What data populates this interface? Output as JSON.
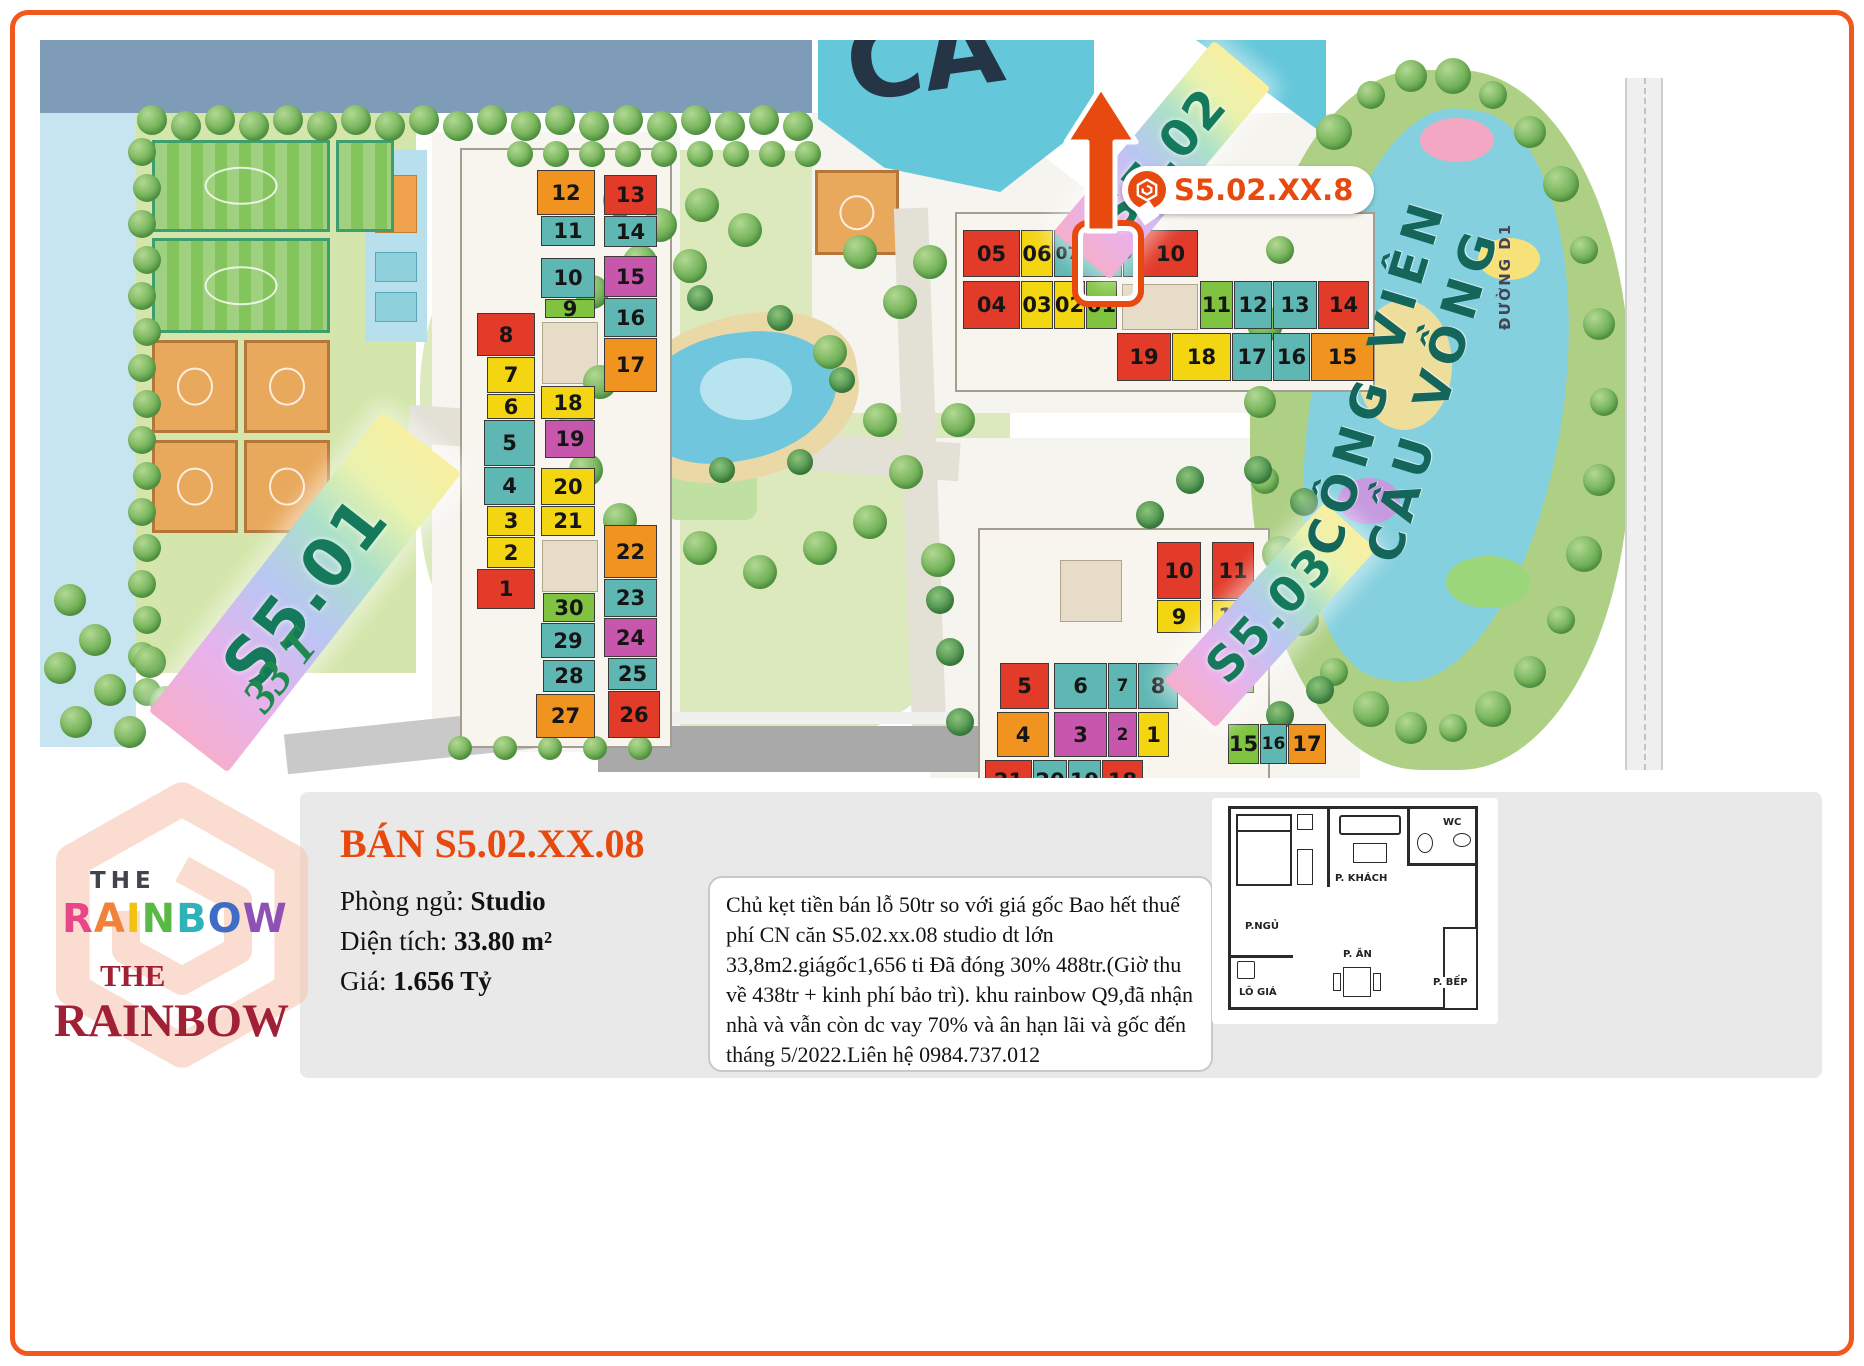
{
  "colors": {
    "accent": "#f2571c",
    "title": "#e8490f",
    "park_text": "#15665a",
    "logo_red": "#a02136",
    "unit": {
      "red": "#e23b2a",
      "yellow": "#f4d512",
      "teal": "#5fb7b4",
      "green": "#7fc341",
      "orange": "#f0931f",
      "magenta": "#c757ad"
    }
  },
  "map": {
    "banner_s501": "S5.01",
    "banner_s502": "S5.02",
    "banner_s503": "S5.03",
    "floors_label": "33 T",
    "park_name_line1": "CÔNG VIÊN",
    "park_name_line2": "CẦU VỒNG",
    "road_label": "ĐƯỜNG D1",
    "pool_letters": "CẦ",
    "callout_label": "S5.02.XX.8",
    "highlighted_unit": "08",
    "buildings": {
      "s501": {
        "units": [
          {
            "n": "12",
            "c": "orange",
            "x": 537,
            "y": 170,
            "w": 58,
            "h": 45
          },
          {
            "n": "13",
            "c": "red",
            "x": 604,
            "y": 175,
            "w": 53,
            "h": 40
          },
          {
            "n": "11",
            "c": "teal",
            "x": 541,
            "y": 216,
            "w": 54,
            "h": 30
          },
          {
            "n": "14",
            "c": "teal",
            "x": 604,
            "y": 216,
            "w": 53,
            "h": 31
          },
          {
            "n": "10",
            "c": "teal",
            "x": 541,
            "y": 258,
            "w": 54,
            "h": 40
          },
          {
            "n": "15",
            "c": "magenta",
            "x": 604,
            "y": 256,
            "w": 53,
            "h": 41
          },
          {
            "n": "9",
            "c": "green",
            "x": 545,
            "y": 299,
            "w": 50,
            "h": 19
          },
          {
            "n": "16",
            "c": "teal",
            "x": 604,
            "y": 298,
            "w": 53,
            "h": 39
          },
          {
            "n": "17",
            "c": "orange",
            "x": 604,
            "y": 338,
            "w": 53,
            "h": 54
          },
          {
            "n": "8",
            "c": "red",
            "x": 477,
            "y": 313,
            "w": 58,
            "h": 43
          },
          {
            "n": "7",
            "c": "yellow",
            "x": 487,
            "y": 357,
            "w": 48,
            "h": 36
          },
          {
            "n": "6",
            "c": "yellow",
            "x": 487,
            "y": 394,
            "w": 48,
            "h": 25
          },
          {
            "n": "18",
            "c": "yellow",
            "x": 541,
            "y": 386,
            "w": 54,
            "h": 33
          },
          {
            "n": "5",
            "c": "teal",
            "x": 484,
            "y": 420,
            "w": 51,
            "h": 46
          },
          {
            "n": "19",
            "c": "magenta",
            "x": 545,
            "y": 420,
            "w": 50,
            "h": 38
          },
          {
            "n": "4",
            "c": "teal",
            "x": 484,
            "y": 467,
            "w": 51,
            "h": 38
          },
          {
            "n": "20",
            "c": "yellow",
            "x": 541,
            "y": 468,
            "w": 54,
            "h": 37
          },
          {
            "n": "3",
            "c": "yellow",
            "x": 487,
            "y": 506,
            "w": 48,
            "h": 30
          },
          {
            "n": "21",
            "c": "yellow",
            "x": 541,
            "y": 506,
            "w": 54,
            "h": 30
          },
          {
            "n": "2",
            "c": "yellow",
            "x": 487,
            "y": 537,
            "w": 48,
            "h": 31
          },
          {
            "n": "22",
            "c": "orange",
            "x": 604,
            "y": 525,
            "w": 53,
            "h": 53
          },
          {
            "n": "1",
            "c": "red",
            "x": 477,
            "y": 569,
            "w": 58,
            "h": 40
          },
          {
            "n": "30",
            "c": "green",
            "x": 543,
            "y": 593,
            "w": 52,
            "h": 29
          },
          {
            "n": "23",
            "c": "teal",
            "x": 604,
            "y": 579,
            "w": 53,
            "h": 38
          },
          {
            "n": "29",
            "c": "teal",
            "x": 541,
            "y": 623,
            "w": 54,
            "h": 35
          },
          {
            "n": "24",
            "c": "magenta",
            "x": 604,
            "y": 618,
            "w": 53,
            "h": 39
          },
          {
            "n": "28",
            "c": "teal",
            "x": 543,
            "y": 660,
            "w": 52,
            "h": 32
          },
          {
            "n": "25",
            "c": "teal",
            "x": 608,
            "y": 658,
            "w": 49,
            "h": 32
          },
          {
            "n": "27",
            "c": "orange",
            "x": 536,
            "y": 694,
            "w": 59,
            "h": 44
          },
          {
            "n": "26",
            "c": "red",
            "x": 608,
            "y": 691,
            "w": 52,
            "h": 47
          }
        ]
      },
      "s502": {
        "units": [
          {
            "n": "05",
            "c": "red",
            "x": 963,
            "y": 230,
            "w": 57,
            "h": 47
          },
          {
            "n": "06",
            "c": "yellow",
            "x": 1021,
            "y": 230,
            "w": 32,
            "h": 47
          },
          {
            "n": "07",
            "c": "teal",
            "x": 1054,
            "y": 230,
            "w": 27,
            "h": 47
          },
          {
            "n": "08",
            "c": "teal",
            "x": 1082,
            "y": 230,
            "w": 40,
            "h": 47,
            "hl": true
          },
          {
            "n": "09",
            "c": "teal",
            "x": 1123,
            "y": 230,
            "w": 19,
            "h": 47
          },
          {
            "n": "10",
            "c": "red",
            "x": 1143,
            "y": 230,
            "w": 55,
            "h": 47
          },
          {
            "n": "04",
            "c": "red",
            "x": 963,
            "y": 281,
            "w": 57,
            "h": 48
          },
          {
            "n": "03",
            "c": "yellow",
            "x": 1021,
            "y": 281,
            "w": 32,
            "h": 48
          },
          {
            "n": "02",
            "c": "yellow",
            "x": 1054,
            "y": 281,
            "w": 31,
            "h": 48
          },
          {
            "n": "01",
            "c": "green",
            "x": 1086,
            "y": 281,
            "w": 31,
            "h": 48
          },
          {
            "n": "11",
            "c": "green",
            "x": 1200,
            "y": 281,
            "w": 33,
            "h": 48
          },
          {
            "n": "12",
            "c": "teal",
            "x": 1234,
            "y": 281,
            "w": 38,
            "h": 48
          },
          {
            "n": "13",
            "c": "teal",
            "x": 1273,
            "y": 281,
            "w": 44,
            "h": 48
          },
          {
            "n": "14",
            "c": "red",
            "x": 1318,
            "y": 281,
            "w": 51,
            "h": 48
          },
          {
            "n": "19",
            "c": "red",
            "x": 1117,
            "y": 333,
            "w": 54,
            "h": 48
          },
          {
            "n": "18",
            "c": "yellow",
            "x": 1172,
            "y": 333,
            "w": 59,
            "h": 48
          },
          {
            "n": "17",
            "c": "teal",
            "x": 1232,
            "y": 333,
            "w": 40,
            "h": 48
          },
          {
            "n": "16",
            "c": "teal",
            "x": 1273,
            "y": 333,
            "w": 37,
            "h": 48
          },
          {
            "n": "15",
            "c": "orange",
            "x": 1311,
            "y": 333,
            "w": 63,
            "h": 48
          }
        ]
      },
      "s503": {
        "units": [
          {
            "n": "10",
            "c": "red",
            "x": 1157,
            "y": 542,
            "w": 44,
            "h": 57
          },
          {
            "n": "11",
            "c": "red",
            "x": 1212,
            "y": 542,
            "w": 42,
            "h": 57
          },
          {
            "n": "9",
            "c": "yellow",
            "x": 1157,
            "y": 600,
            "w": 44,
            "h": 33
          },
          {
            "n": "12",
            "c": "yellow",
            "x": 1212,
            "y": 600,
            "w": 42,
            "h": 32
          },
          {
            "n": "13",
            "c": "yellow",
            "x": 1212,
            "y": 633,
            "w": 42,
            "h": 30
          },
          {
            "n": "14",
            "c": "green",
            "x": 1212,
            "y": 664,
            "w": 42,
            "h": 29
          },
          {
            "n": "5",
            "c": "red",
            "x": 1000,
            "y": 663,
            "w": 49,
            "h": 46
          },
          {
            "n": "6",
            "c": "teal",
            "x": 1054,
            "y": 663,
            "w": 53,
            "h": 46
          },
          {
            "n": "7",
            "c": "teal",
            "x": 1108,
            "y": 663,
            "w": 29,
            "h": 46
          },
          {
            "n": "8",
            "c": "teal",
            "x": 1138,
            "y": 663,
            "w": 40,
            "h": 46
          },
          {
            "n": "4",
            "c": "orange",
            "x": 997,
            "y": 712,
            "w": 52,
            "h": 45
          },
          {
            "n": "3",
            "c": "magenta",
            "x": 1054,
            "y": 712,
            "w": 53,
            "h": 45
          },
          {
            "n": "2",
            "c": "magenta",
            "x": 1108,
            "y": 712,
            "w": 29,
            "h": 45
          },
          {
            "n": "1",
            "c": "yellow",
            "x": 1138,
            "y": 712,
            "w": 31,
            "h": 45
          },
          {
            "n": "15",
            "c": "green",
            "x": 1228,
            "y": 724,
            "w": 31,
            "h": 40
          },
          {
            "n": "16",
            "c": "teal",
            "x": 1260,
            "y": 724,
            "w": 27,
            "h": 40
          },
          {
            "n": "17",
            "c": "orange",
            "x": 1288,
            "y": 724,
            "w": 38,
            "h": 40
          },
          {
            "n": "21",
            "c": "red",
            "x": 985,
            "y": 760,
            "w": 47,
            "h": 42
          },
          {
            "n": "20",
            "c": "teal",
            "x": 1033,
            "y": 760,
            "w": 34,
            "h": 42
          },
          {
            "n": "19",
            "c": "teal",
            "x": 1068,
            "y": 760,
            "w": 33,
            "h": 42
          },
          {
            "n": "18",
            "c": "red",
            "x": 1102,
            "y": 760,
            "w": 41,
            "h": 42
          }
        ]
      }
    }
  },
  "panel": {
    "title": "BÁN S5.02.XX.08",
    "bedroom_label": "Phòng ngủ:",
    "bedroom_value": "Studio",
    "area_label": "Diện tích:",
    "area_value": "33.80 m²",
    "price_label": "Giá:",
    "price_value": "1.656 Tỷ",
    "description": "Chủ kẹt tiền bán lỗ 50tr so với giá gốc Bao hết thuế phí CN căn S5.02.xx.08 studio dt lớn 33,8m2.giágốc1,656 ti Đã đóng 30% 488tr.(Giờ thu về 438tr + kinh phí bảo trì). khu rainbow Q9,đã nhận nhà và vẫn còn dc vay 70% và ân hạn lãi và gốc đến tháng 5/2022.Liên hệ 0984.737.012"
  },
  "logo": {
    "the_top": "THE",
    "rainbow_top": "RAINBOW",
    "the_bottom": "THE",
    "rainbow_bottom": "RAINBOW",
    "letter_colors": [
      "#e8468b",
      "#f0823c",
      "#f2c20f",
      "#58b947",
      "#2fb3b9",
      "#3f6cc4",
      "#8e52b5"
    ]
  },
  "floorplan": {
    "living": "P. KHÁCH",
    "wc": "WC",
    "bedroom": "P.NGỦ",
    "dining": "P. ĂN",
    "kitchen": "P. BẾP",
    "balcony": "LÔ GIÁ"
  }
}
